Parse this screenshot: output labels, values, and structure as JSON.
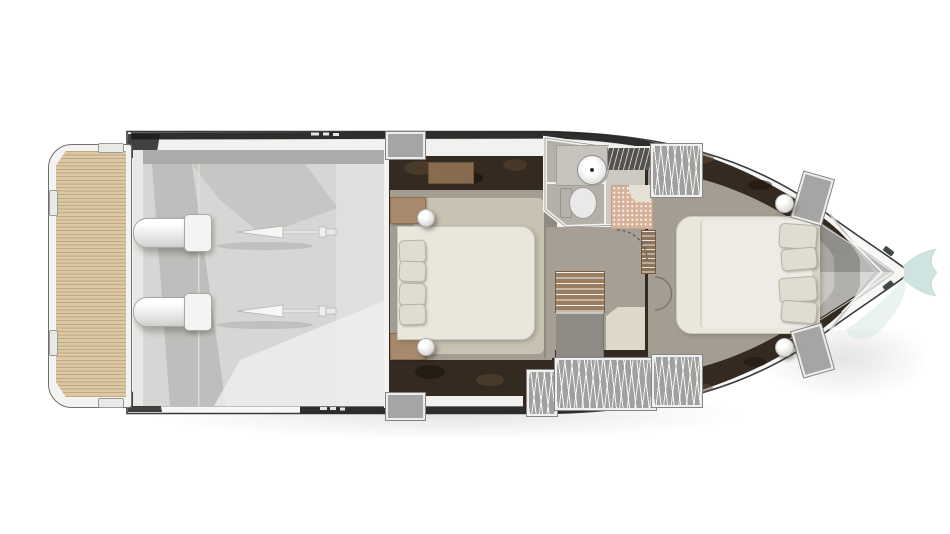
{
  "meta": {
    "title": "Motor yacht lower-deck floor plan",
    "view": "top-down plan",
    "orientation": "bow pointing right, stern with swim platform at left",
    "canvas": {
      "width": 950,
      "height": 534
    }
  },
  "palette": {
    "background": "#ffffff",
    "hull_outline": "#3a3a38",
    "hull_fill": "#f7f7f5",
    "deck_fill": "#f1f1ef",
    "glazing_band": "#1e1e1c",
    "teak_light": "#dbc8a4",
    "teak_groove": "#c2a981",
    "engine_room_floor": "#d6d6d4",
    "shadow_gray": "#a2a2a0",
    "engine_white": "#fbfbf9",
    "marble_dark": "#352a1f",
    "marble_vein": "#5e4936",
    "carpet_taupe": "#a49e92",
    "carpet_beige": "#c8c2b2",
    "bed_cream": "#e9e6dc",
    "duvet_white": "#edebe3",
    "pillow_beige": "#e0dcd0",
    "wood_tan": "#a8896c",
    "closet_brown": "#9a7d61",
    "locker_gray": "#a0a09e",
    "bathroom_floor": "#b4b0a8",
    "shower_mosaic": "#d7b29a",
    "fixture_white": "#ededeb",
    "wall_white": "#f4f4f2",
    "accent_teal": "#cfe3e0"
  },
  "rooms": {
    "swim_platform": {
      "name": "Swim platform",
      "features": [
        "teak decking",
        "two transom cleats",
        "two deck latches"
      ]
    },
    "engine_room": {
      "name": "Engine room",
      "features": [
        "port engine with shaft and propeller cone",
        "starboard engine with shaft and propeller cone",
        "service bulkhead with two steps"
      ]
    },
    "vip_cabin": {
      "name": "VIP guest cabin (midship)",
      "features": [
        "double bed with four pillows",
        "two ball bedside lamps",
        "tan bedside cabinets",
        "dark marble floor border",
        "beige carpet"
      ]
    },
    "bathroom": {
      "name": "Bathroom / day head",
      "features": [
        "round washbasin on counter",
        "toilet",
        "shower with mosaic tile floor",
        "slatted vent shelf",
        "dashed swing door"
      ]
    },
    "landing": {
      "name": "Companionway landing",
      "features": [
        "hanging closet",
        "storage cabinet",
        "linen shelves",
        "double swing doors to owner cabin",
        "three slatted hanging lockers"
      ]
    },
    "owner_cabin": {
      "name": "Owner cabin (forward)",
      "features": [
        "island double bed with four pillows",
        "two ball bedside lamps",
        "two slatted hanging lockers",
        "two angled bedside lockers",
        "dark marble floor border"
      ]
    },
    "bow": {
      "name": "Bow deck",
      "features": [
        "anchor locker chevron",
        "two mooring cleats",
        "teal whale-tail bow accent"
      ]
    }
  }
}
